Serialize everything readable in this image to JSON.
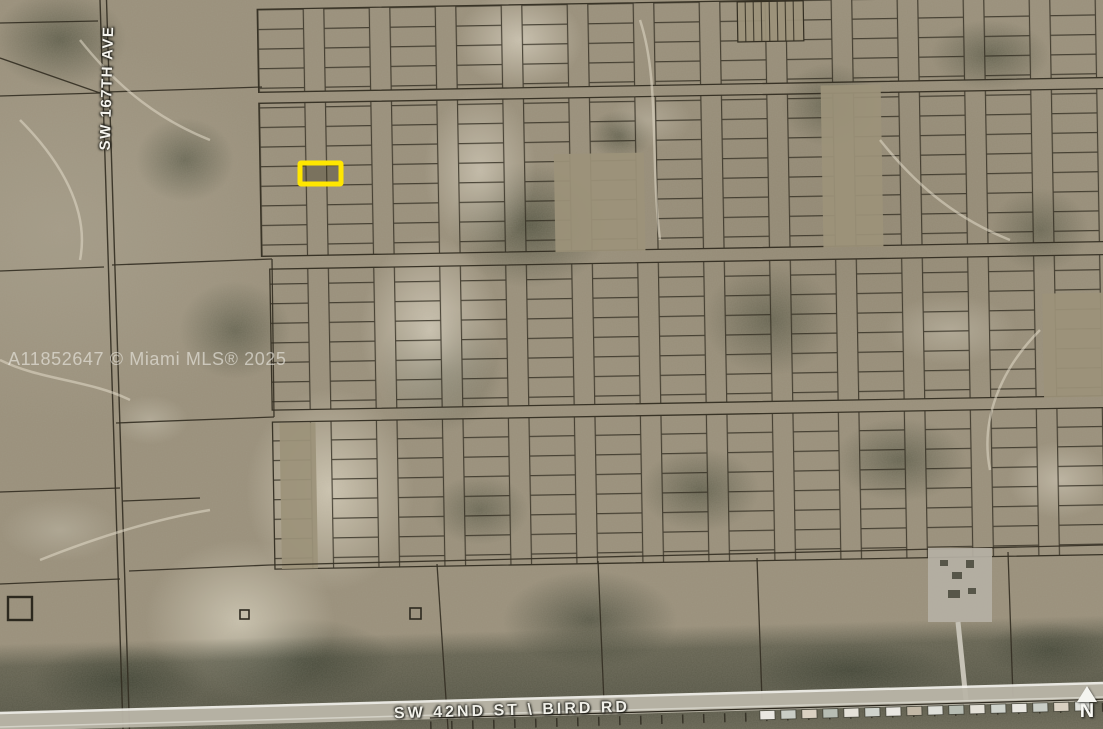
{
  "map": {
    "watermark": "A11852647 © Miami MLS® 2025",
    "labels": {
      "street_vertical": "SW 167TH AVE",
      "street_horizontal": "SW 42ND ST \\ BIRD RD",
      "north": "N"
    },
    "highlight_parcel": {
      "x": 300,
      "y": 163,
      "width": 41,
      "height": 21,
      "color": "#FFE600"
    },
    "colors": {
      "terrain_base": "#9A907B",
      "sand_wash": "#D2CAB8",
      "vegetation": "#3A3F2C",
      "parcel_line": "#332E22",
      "road_surface": "#B9B5A8",
      "street_label_text": "#F2F1EA",
      "watermark_text": "#F0EEE8",
      "north_arrow": "#F5F5F0"
    }
  }
}
